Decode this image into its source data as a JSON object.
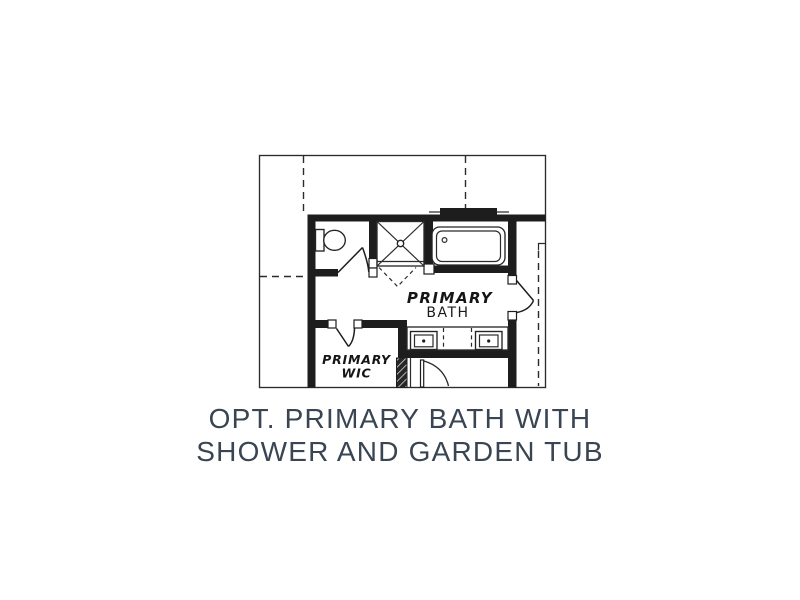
{
  "caption": {
    "line1": "OPT. PRIMARY BATH WITH",
    "line2": "SHOWER AND GARDEN TUB",
    "color": "#3a4553"
  },
  "plan": {
    "bath_label": {
      "line1": "PRIMARY",
      "line2": "BATH"
    },
    "wic_label": {
      "line1": "PRIMARY",
      "line2": "WIC"
    },
    "fixtures": [
      "toilet",
      "shower",
      "garden-tub",
      "double-sink-vanity"
    ],
    "colors": {
      "wall": "#1d1d1d",
      "line": "#2b2b2b",
      "caption_text": "#3a4553",
      "background": "#ffffff"
    }
  }
}
